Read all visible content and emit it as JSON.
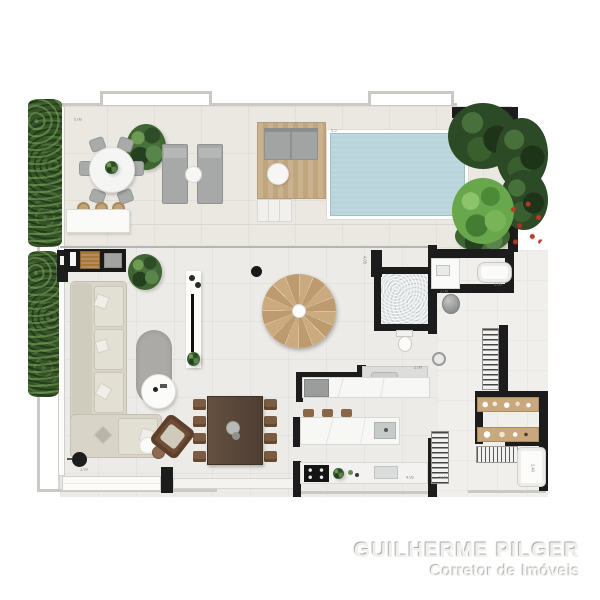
{
  "watermark": {
    "title": "GUILHERME PILGER",
    "subtitle": "Corretor de Imóveis"
  },
  "dimension_labels": [
    "5.00",
    "5.5",
    "4.05",
    "2.06",
    "2.66",
    "2.08",
    "1.50",
    "4.95",
    "5.90",
    "2.40"
  ],
  "palette": {
    "wall": "#1c1c1c",
    "pool_water": "#b9d5db",
    "deck_wood": "#c9b18d",
    "stair_wood": "#c9a87d",
    "sofa_beige": "#d8d5c8",
    "hedge_green": "#365428",
    "bush_green": "#68a74c",
    "floor_tile": "#edebe7",
    "watermark_gray": "#f0f0ee"
  }
}
